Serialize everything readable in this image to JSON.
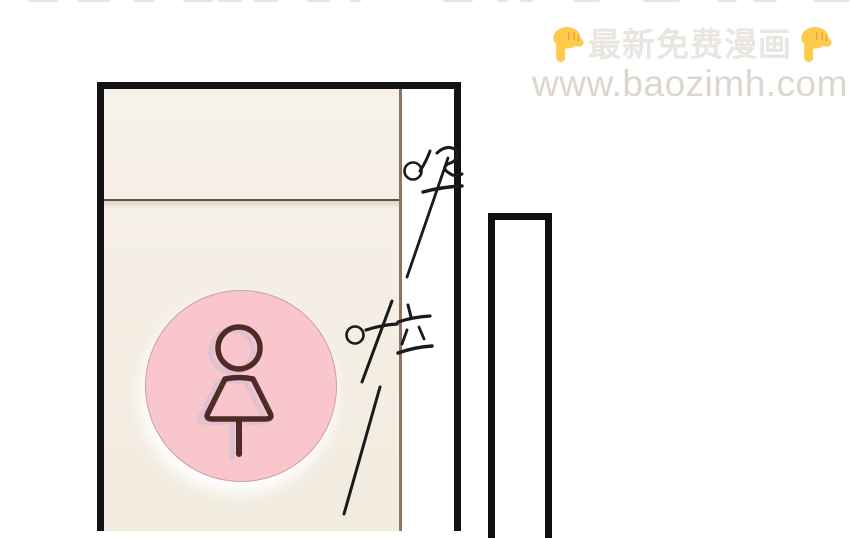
{
  "watermark": {
    "line1": "最新免费漫画",
    "line2": "www.baozimh.com",
    "left_icon": "backhand-index-pointing-down-emoji",
    "right_icon": "backhand-index-pointing-down-emoji",
    "line1_color": "#e9e6e1",
    "line2_color": "#dcd6cd",
    "emoji_color": "#ffcb4d"
  },
  "panel": {
    "sound_effects": [
      {
        "text": "哗"
      },
      {
        "text": "啦"
      }
    ],
    "door": {
      "fill_color": "#f4eee4",
      "frame_color": "#121212",
      "edge_line_color": "#8d7465",
      "divider_color": "#60524a"
    },
    "sign": {
      "icon": "female-figure-icon",
      "circle_color": "#f9c6cc",
      "figure_color": "#4e2b26"
    },
    "right_panel": {
      "frame_color": "#0f0f0f",
      "fill_color": "#ffffff"
    }
  }
}
